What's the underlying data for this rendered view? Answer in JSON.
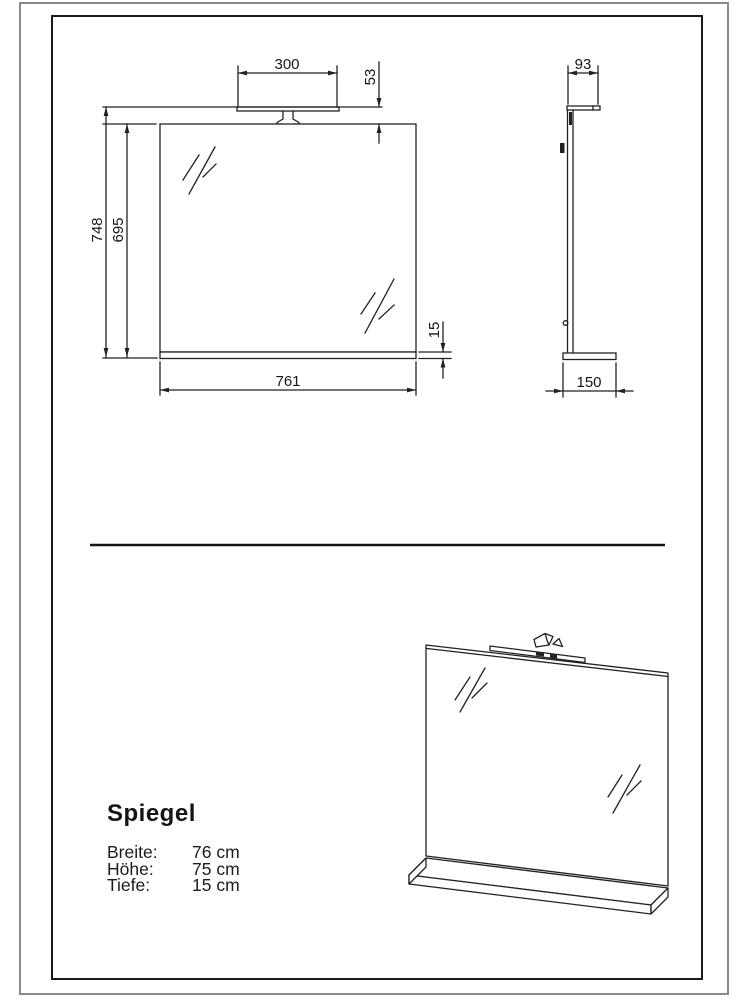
{
  "page": {
    "background": "#ffffff",
    "line_color": "#222222",
    "frame_color": "#1a1a1a",
    "outer_border_color": "#8a8a8a"
  },
  "front_view": {
    "dim_lamp_width": "300",
    "dim_lamp_height": "53",
    "dim_total_height": "748",
    "dim_mirror_height": "695",
    "dim_shelf_thickness": "15",
    "dim_width": "761"
  },
  "side_view": {
    "dim_lamp_depth": "93",
    "dim_shelf_depth": "150"
  },
  "product": {
    "title": "Spiegel",
    "specs": [
      {
        "label": "Breite:",
        "value": "76 cm"
      },
      {
        "label": "Höhe:",
        "value": "75 cm"
      },
      {
        "label": "Tiefe:",
        "value": "15 cm"
      }
    ]
  }
}
